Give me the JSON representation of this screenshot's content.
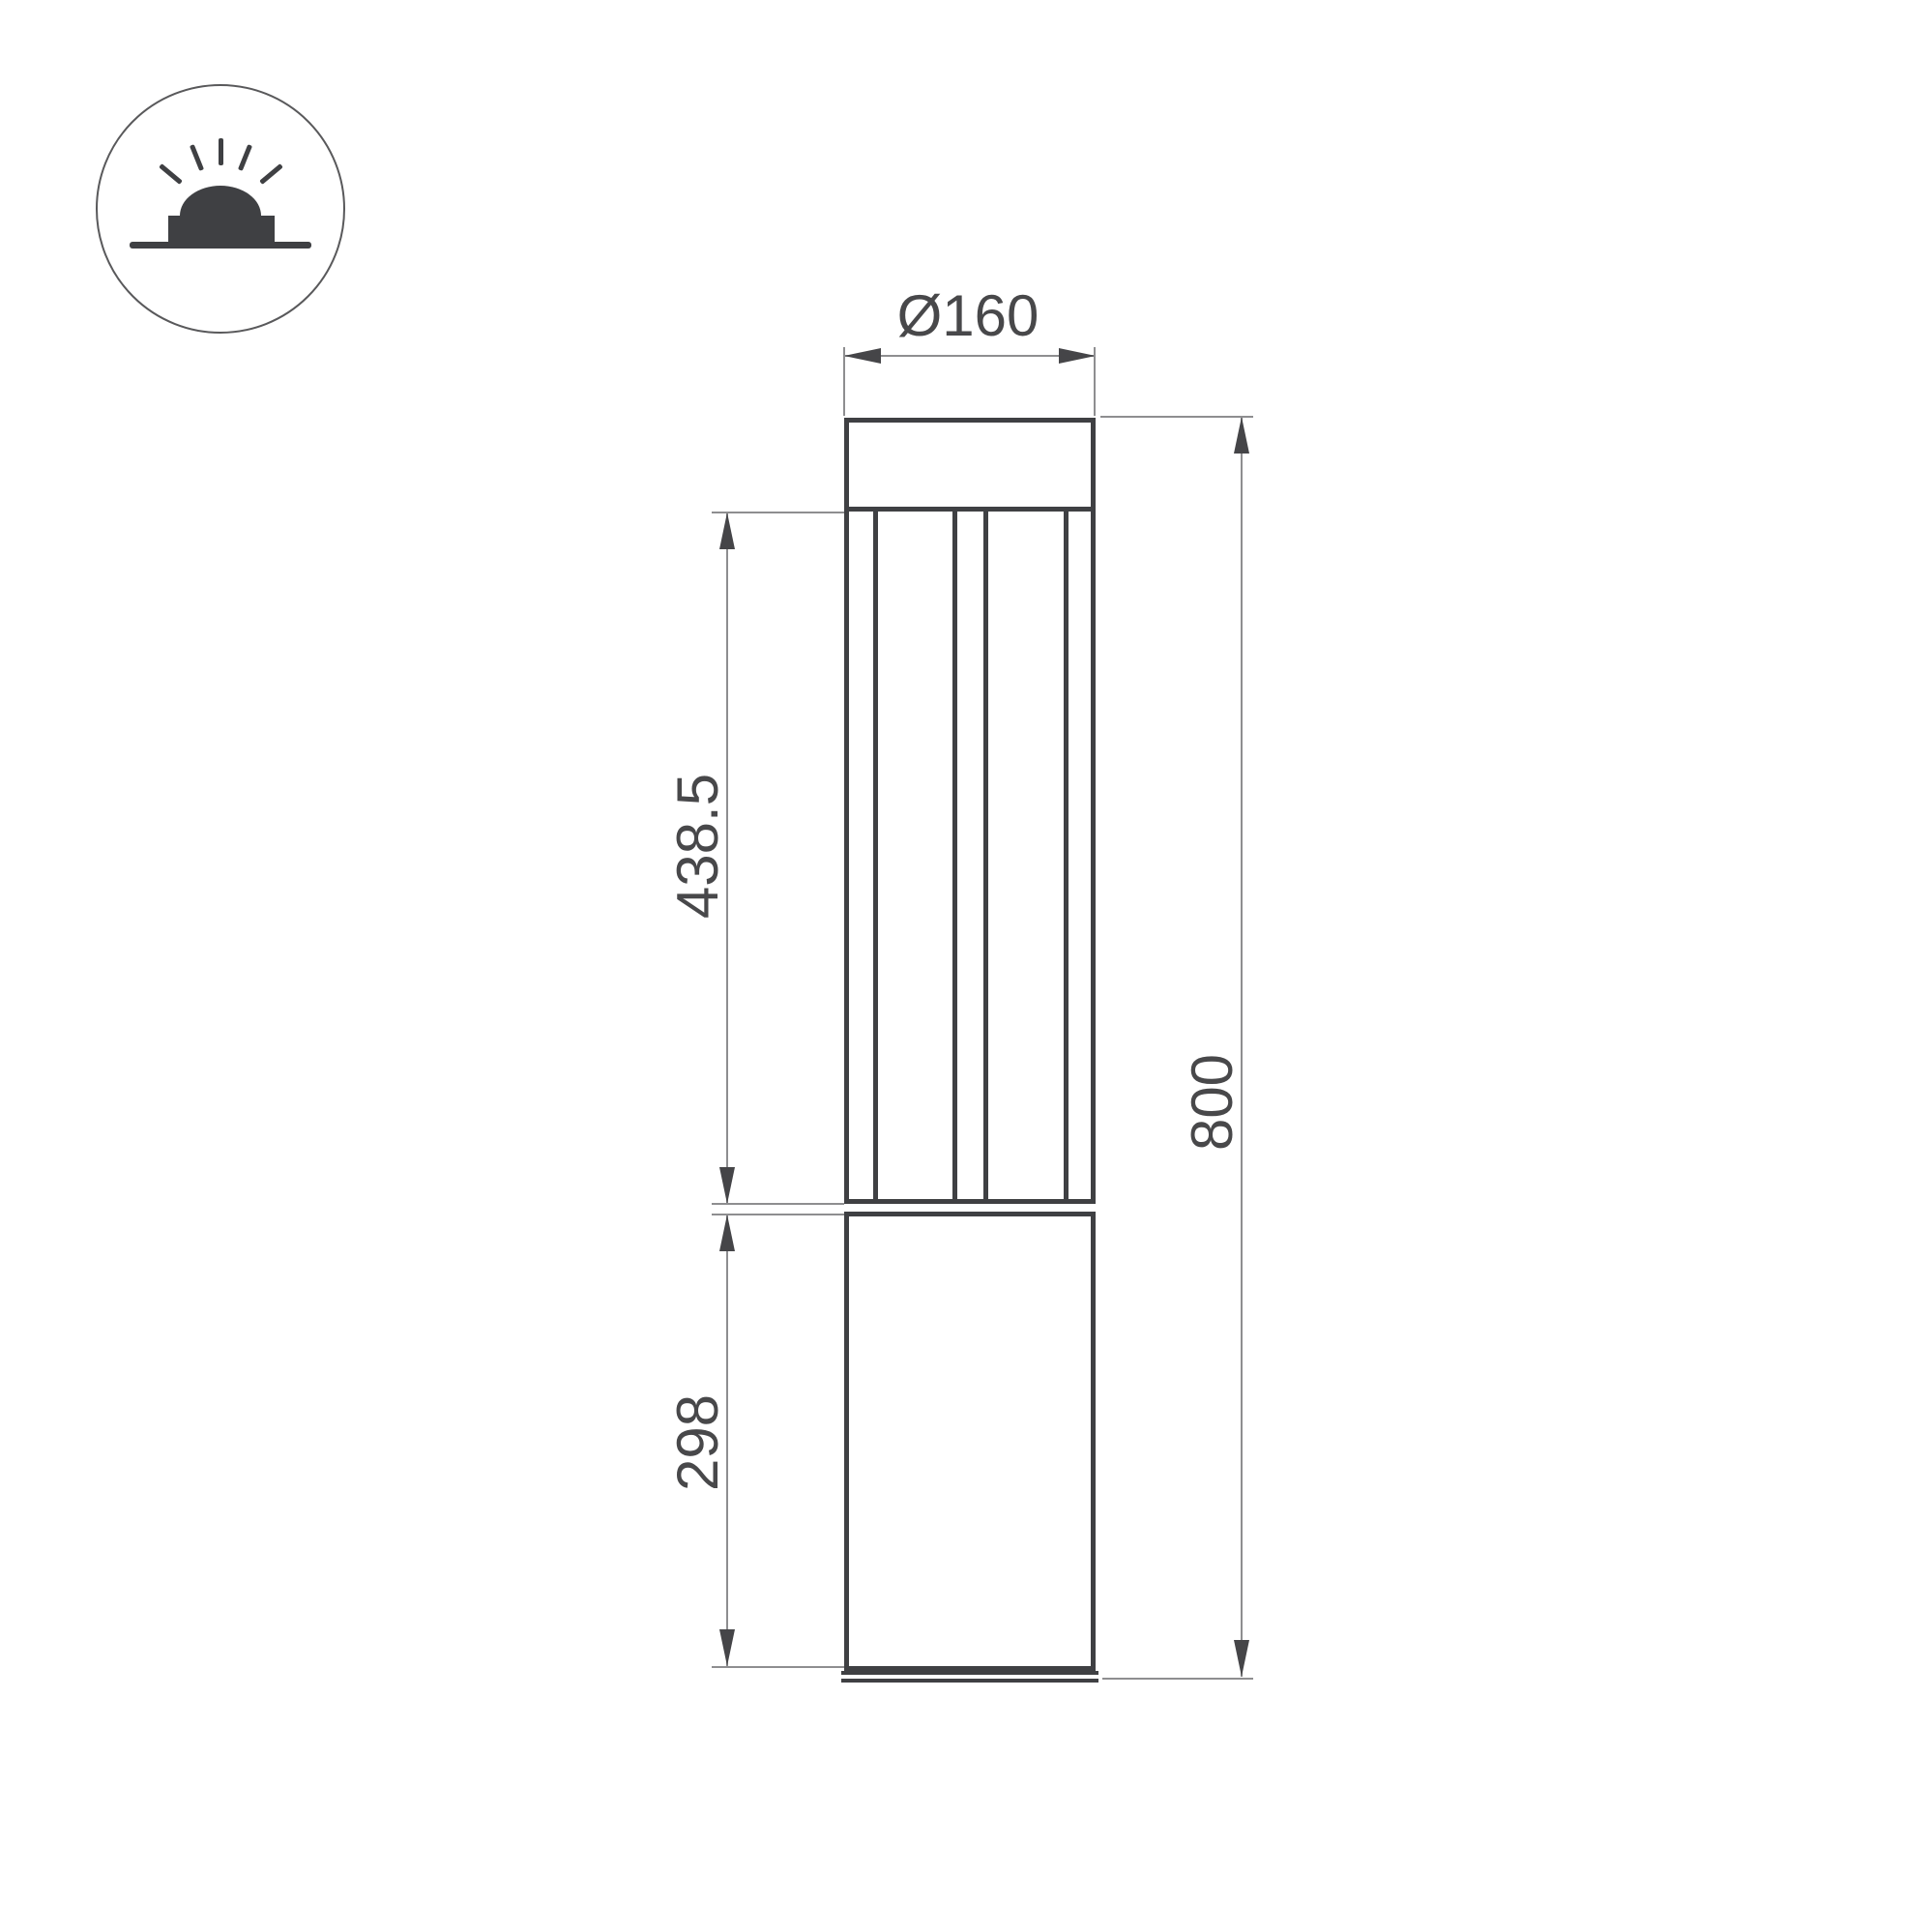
{
  "icon": {
    "name": "bollard-ground-light-icon",
    "description_glyphs": [
      "circle-outline",
      "light-rays",
      "dome",
      "fixture-base",
      "ground-line"
    ]
  },
  "dimensions": {
    "diameter": {
      "label": "Ø160"
    },
    "upper_section_height": {
      "label": "438.5"
    },
    "lower_section_height": {
      "label": "298"
    },
    "total_height": {
      "label": "800"
    }
  },
  "colors": {
    "background": "#ffffff",
    "structure_line": "#3f4043",
    "dimension_thin_line": "#8e8e90",
    "arrow": "#454548",
    "text": "#48484a",
    "icon_circle_stroke": "#59595b"
  }
}
